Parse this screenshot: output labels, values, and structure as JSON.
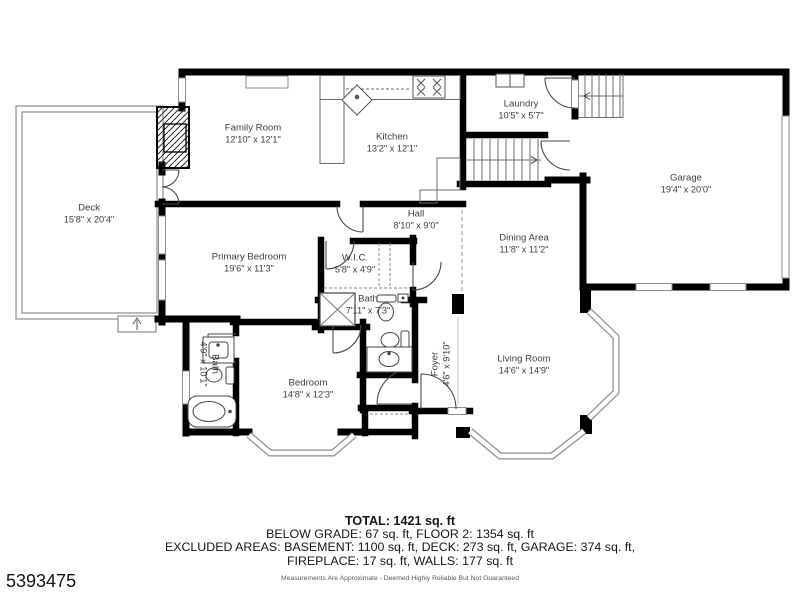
{
  "listing": {
    "id_number": "5393475"
  },
  "floorplan": {
    "rooms": [
      {
        "name": "Deck",
        "dims": "15'8\" x 20'4\""
      },
      {
        "name": "Family Room",
        "dims": "12'10\" x 12'1\""
      },
      {
        "name": "Kitchen",
        "dims": "13'2\" x 12'1\""
      },
      {
        "name": "Laundry",
        "dims": "10'5\" x 5'7\""
      },
      {
        "name": "Garage",
        "dims": "19'4\" x 20'0\""
      },
      {
        "name": "Hall",
        "dims": "8'10\" x 9'0\""
      },
      {
        "name": "Dining Area",
        "dims": "11'8\" x 11'2\""
      },
      {
        "name": "Primary Bedroom",
        "dims": "19'6\" x 11'3\""
      },
      {
        "name": "W.I.C.",
        "dims": "5'8\" x 4'9\""
      },
      {
        "name": "Bath",
        "dims": "7'11\" x 7'3\""
      },
      {
        "name": "Bath",
        "dims": "4'9\" x 10'1\""
      },
      {
        "name": "Bedroom",
        "dims": "14'8\" x 12'3\""
      },
      {
        "name": "Foyer",
        "dims": "4'6\" x 9'10\""
      },
      {
        "name": "Living Room",
        "dims": "14'6\" x 14'9\""
      }
    ],
    "icons": [
      "fireplace-icon",
      "stove-icon",
      "kitchen-sink-icon",
      "washer-dryer-icon",
      "shower-icon",
      "toilet-icon",
      "bathroom-sink-icon",
      "bathtub-icon",
      "stairs-up-arrow",
      "stairs-down-arrow",
      "deck-steps-arrow"
    ],
    "colors": {
      "wall": "#000000",
      "thin_line": "#8d8d8d",
      "label_text": "#3e3e3e"
    }
  },
  "summary": {
    "total": "TOTAL: 1421 sq. ft",
    "line2": "BELOW GRADE: 67 sq. ft, FLOOR 2: 1354 sq. ft",
    "line3": "EXCLUDED AREAS: BASEMENT: 1100 sq. ft, DECK: 273 sq. ft, GARAGE: 374 sq. ft,",
    "line4": "FIREPLACE: 17 sq. ft, WALLS: 177 sq. ft",
    "disclaimer": "Measurements Are Approximate - Deemed Highly Reliable But Not Guaranteed"
  }
}
